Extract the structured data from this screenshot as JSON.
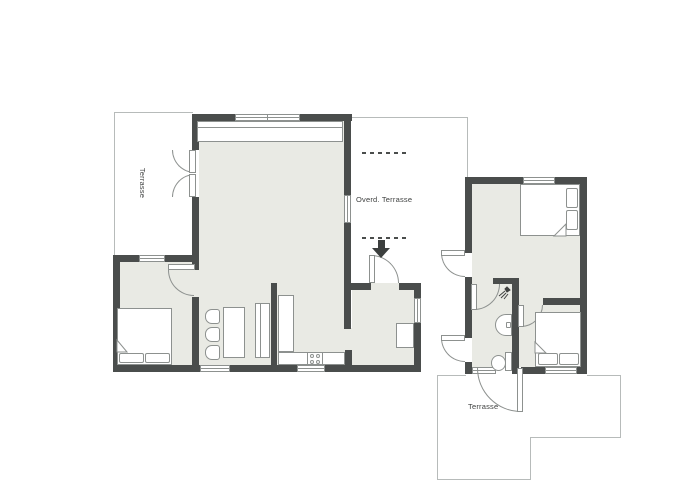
{
  "labels": {
    "left_terrace": "Terrasse",
    "covered_terrace": "Overd. Terrasse",
    "bottom_terrace": "Terrasse"
  },
  "colors": {
    "background": "#ffffff",
    "wall": "#4a4d4c",
    "floor": "#e9eae4",
    "outline": "#8d918f",
    "thin_line": "#b7bbba",
    "text": "#3f4140",
    "arrow": "#3c3f3e",
    "dash": "#4a4d4c"
  },
  "icons": {
    "shower": "shower-icon",
    "sink": "sink-icon",
    "toilet": "toilet-icon",
    "stove": "stove-icon",
    "entrance_arrow": "entrance-arrow-icon"
  }
}
